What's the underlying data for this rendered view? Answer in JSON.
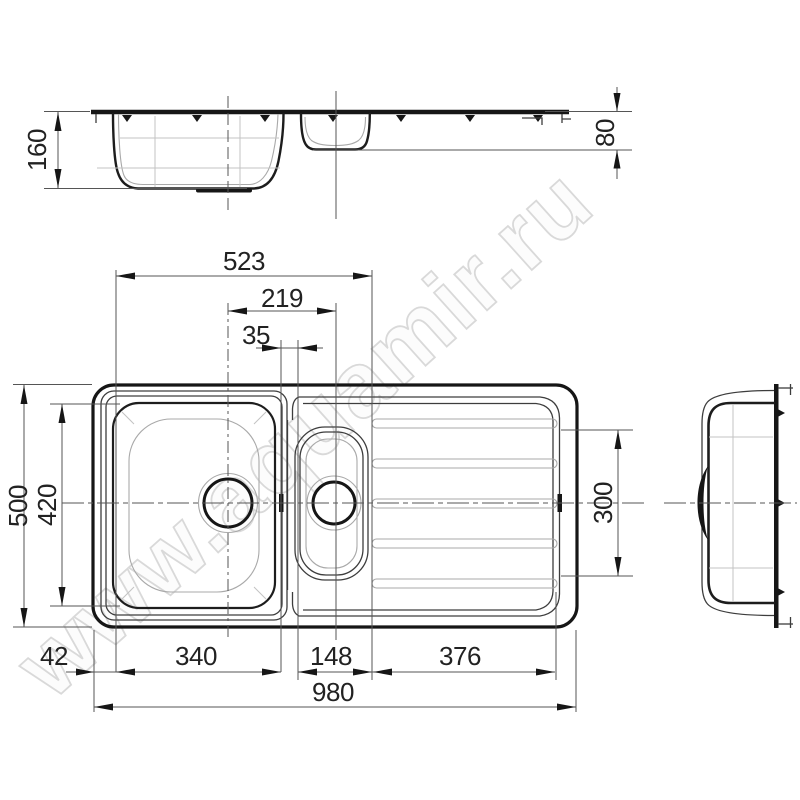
{
  "watermark": "www.aquamir.ru",
  "drawing": {
    "subject": "inset kitchen sink, one and a half bowls with drainer",
    "views": [
      "front-elevation",
      "plan",
      "side-elevation"
    ],
    "units": "mm"
  },
  "views": {
    "front": {
      "dims": {
        "main_bowl_depth": "160",
        "small_bowl_depth": "80"
      }
    },
    "plan": {
      "dims": {
        "bowls_span": "523",
        "drain_spacing": "219",
        "bowl_gap": "35",
        "overall_width": "500",
        "bowl_length": "420",
        "drainer_length": "300",
        "left_margin": "42",
        "main_bowl_width": "340",
        "small_bowl_width": "148",
        "drainer_width": "376",
        "overall_length": "980"
      }
    },
    "side": {
      "dims": {}
    }
  }
}
